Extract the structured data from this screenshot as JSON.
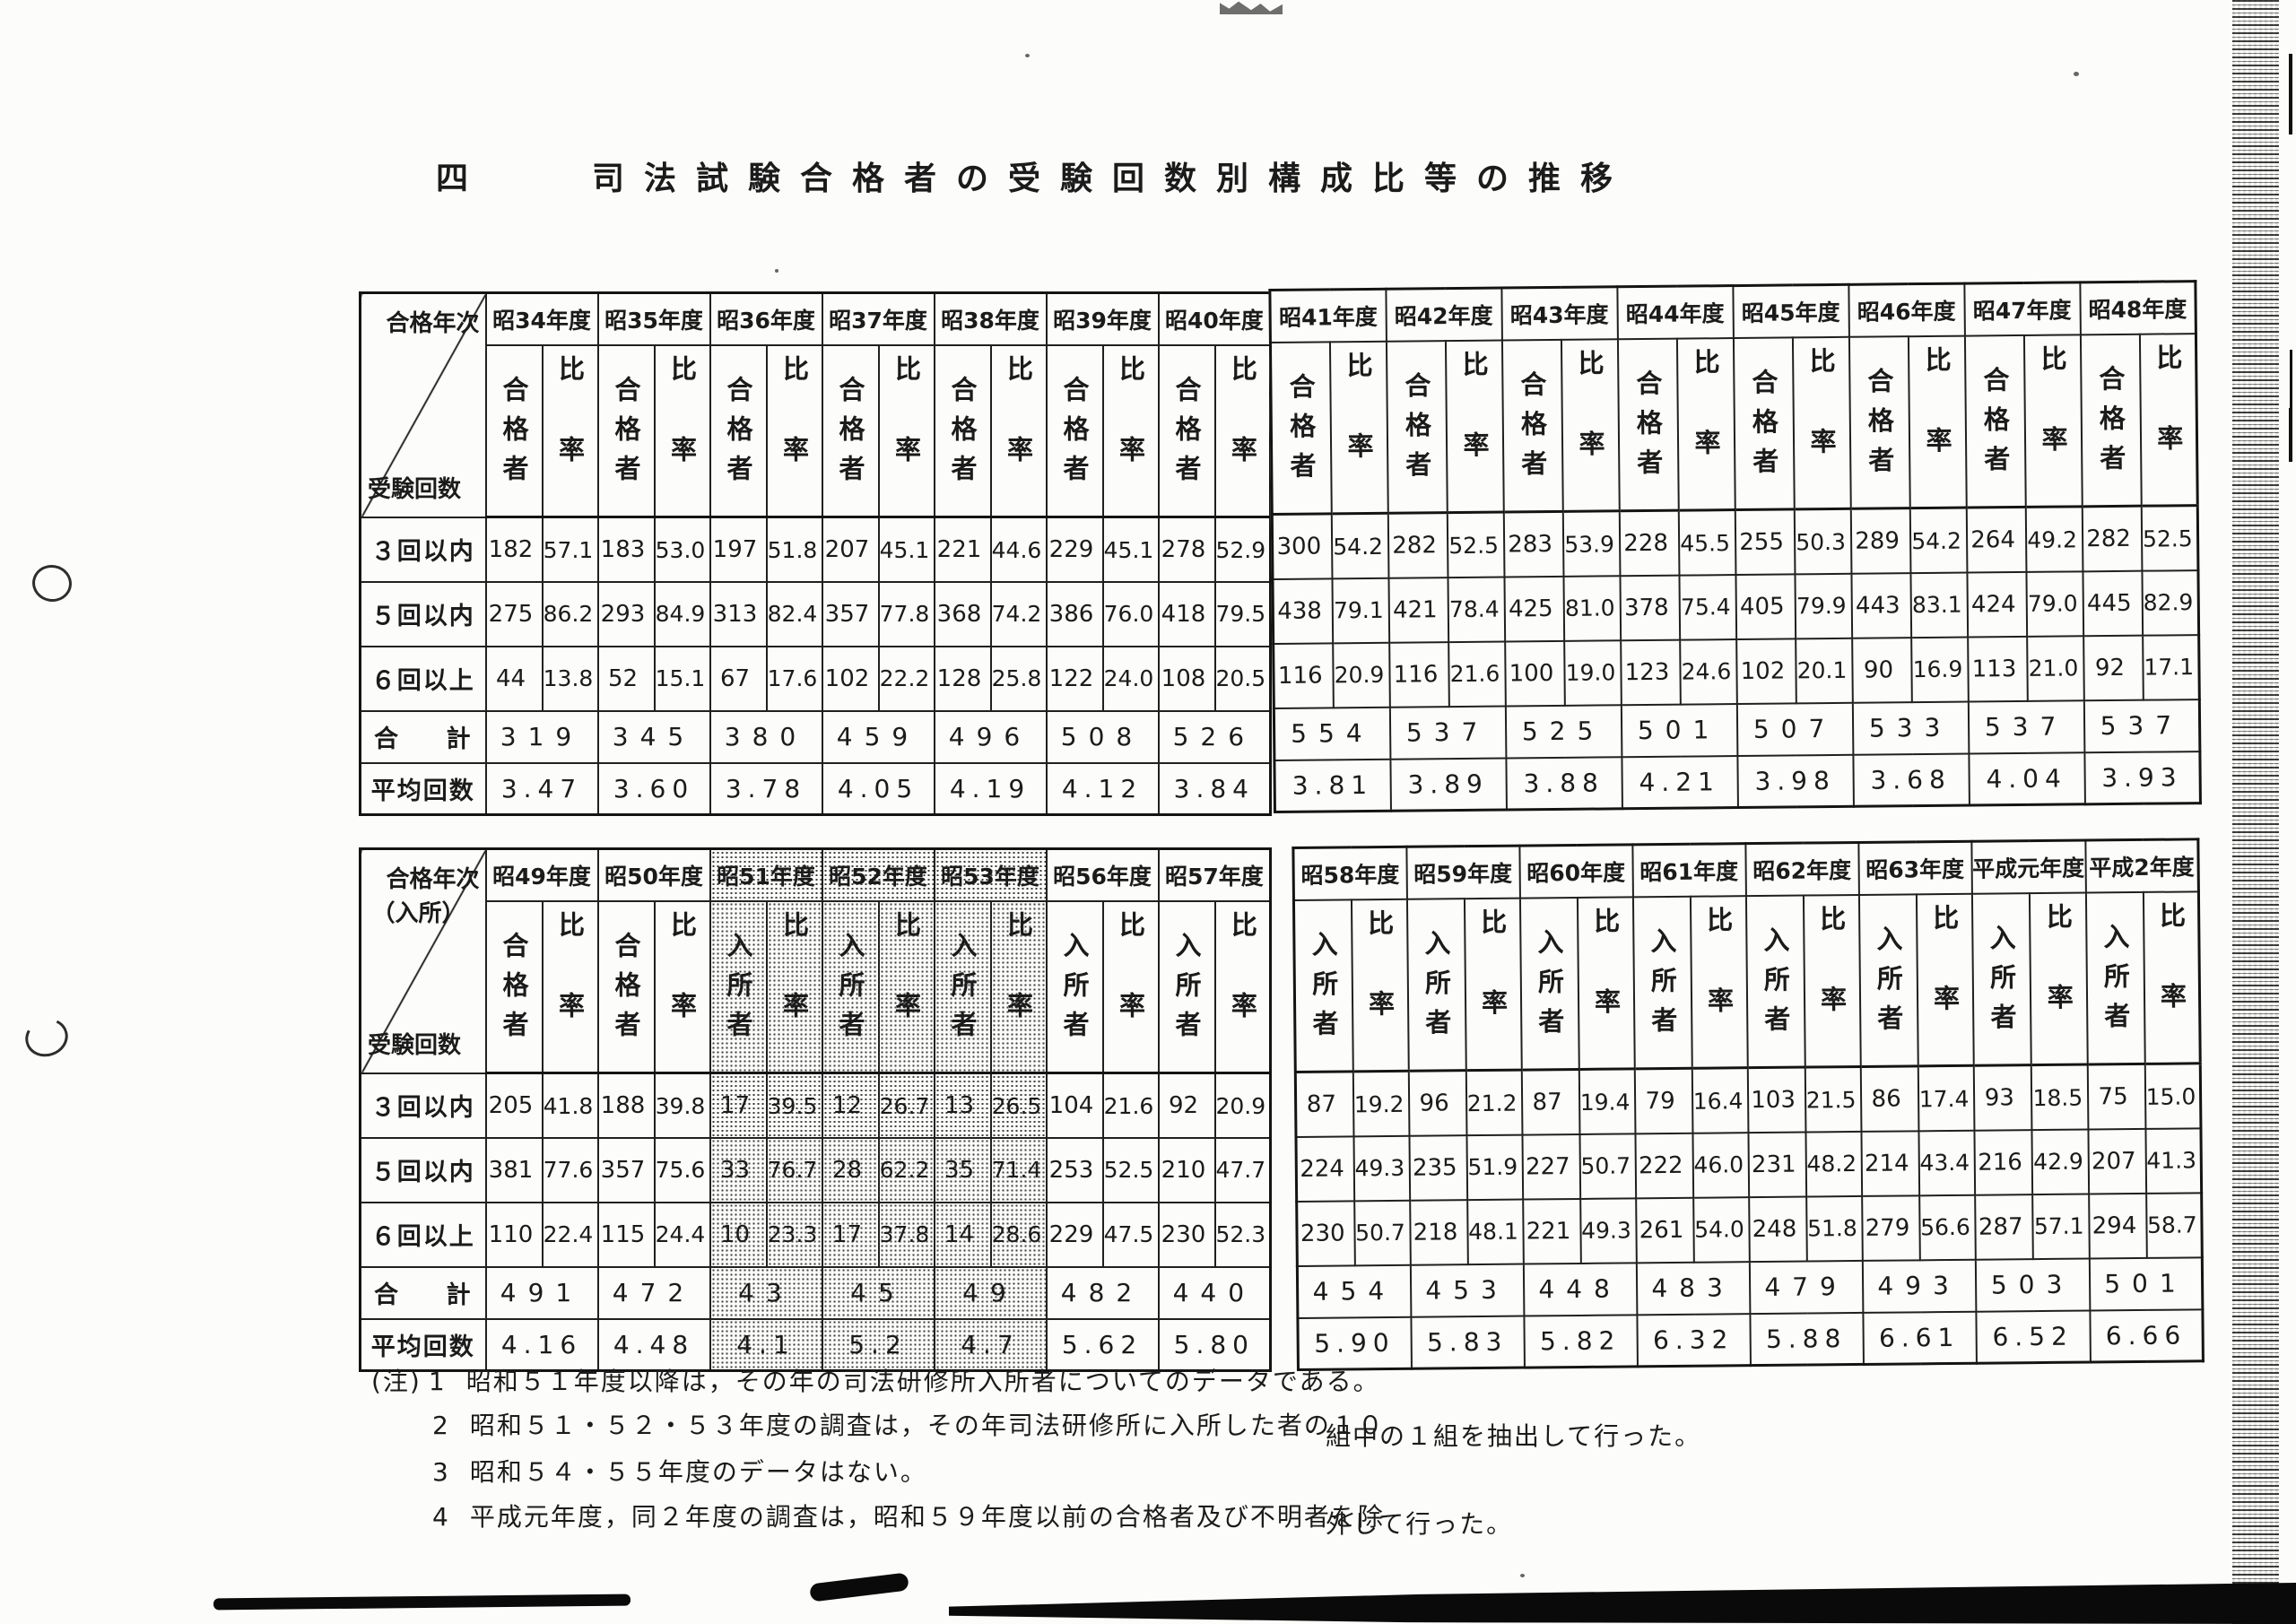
{
  "title": "四　　司法試験合格者の受験回数別構成比等の推移",
  "table1": {
    "corner_top": "合格年次",
    "corner_top2": "",
    "corner_bottom": "受験回数",
    "row_labels": {
      "r3": "３回以内",
      "r5": "５回以内",
      "r6": "６回以上",
      "total": "合　計",
      "avg": "平均回数"
    },
    "left": {
      "years": [
        {
          "year": "昭34年度",
          "head": "合格者",
          "rate_head": "比率",
          "shaded": false,
          "r3": [
            "182",
            "57.1"
          ],
          "r5": [
            "275",
            "86.2"
          ],
          "r6": [
            "44",
            "13.8"
          ],
          "total": "319",
          "avg": "3.47"
        },
        {
          "year": "昭35年度",
          "head": "合格者",
          "rate_head": "比率",
          "shaded": false,
          "r3": [
            "183",
            "53.0"
          ],
          "r5": [
            "293",
            "84.9"
          ],
          "r6": [
            "52",
            "15.1"
          ],
          "total": "345",
          "avg": "3.60"
        },
        {
          "year": "昭36年度",
          "head": "合格者",
          "rate_head": "比率",
          "shaded": false,
          "r3": [
            "197",
            "51.8"
          ],
          "r5": [
            "313",
            "82.4"
          ],
          "r6": [
            "67",
            "17.6"
          ],
          "total": "380",
          "avg": "3.78"
        },
        {
          "year": "昭37年度",
          "head": "合格者",
          "rate_head": "比率",
          "shaded": false,
          "r3": [
            "207",
            "45.1"
          ],
          "r5": [
            "357",
            "77.8"
          ],
          "r6": [
            "102",
            "22.2"
          ],
          "total": "459",
          "avg": "4.05"
        },
        {
          "year": "昭38年度",
          "head": "合格者",
          "rate_head": "比率",
          "shaded": false,
          "r3": [
            "221",
            "44.6"
          ],
          "r5": [
            "368",
            "74.2"
          ],
          "r6": [
            "128",
            "25.8"
          ],
          "total": "496",
          "avg": "4.19"
        },
        {
          "year": "昭39年度",
          "head": "合格者",
          "rate_head": "比率",
          "shaded": false,
          "r3": [
            "229",
            "45.1"
          ],
          "r5": [
            "386",
            "76.0"
          ],
          "r6": [
            "122",
            "24.0"
          ],
          "total": "508",
          "avg": "4.12"
        },
        {
          "year": "昭40年度",
          "head": "合格者",
          "rate_head": "比率",
          "shaded": false,
          "r3": [
            "278",
            "52.9"
          ],
          "r5": [
            "418",
            "79.5"
          ],
          "r6": [
            "108",
            "20.5"
          ],
          "total": "526",
          "avg": "3.84"
        }
      ]
    },
    "right": {
      "years": [
        {
          "year": "昭41年度",
          "head": "合格者",
          "rate_head": "比率",
          "shaded": false,
          "r3": [
            "300",
            "54.2"
          ],
          "r5": [
            "438",
            "79.1"
          ],
          "r6": [
            "116",
            "20.9"
          ],
          "total": "554",
          "avg": "3.81"
        },
        {
          "year": "昭42年度",
          "head": "合格者",
          "rate_head": "比率",
          "shaded": false,
          "r3": [
            "282",
            "52.5"
          ],
          "r5": [
            "421",
            "78.4"
          ],
          "r6": [
            "116",
            "21.6"
          ],
          "total": "537",
          "avg": "3.89"
        },
        {
          "year": "昭43年度",
          "head": "合格者",
          "rate_head": "比率",
          "shaded": false,
          "r3": [
            "283",
            "53.9"
          ],
          "r5": [
            "425",
            "81.0"
          ],
          "r6": [
            "100",
            "19.0"
          ],
          "total": "525",
          "avg": "3.88"
        },
        {
          "year": "昭44年度",
          "head": "合格者",
          "rate_head": "比率",
          "shaded": false,
          "r3": [
            "228",
            "45.5"
          ],
          "r5": [
            "378",
            "75.4"
          ],
          "r6": [
            "123",
            "24.6"
          ],
          "total": "501",
          "avg": "4.21"
        },
        {
          "year": "昭45年度",
          "head": "合格者",
          "rate_head": "比率",
          "shaded": false,
          "r3": [
            "255",
            "50.3"
          ],
          "r5": [
            "405",
            "79.9"
          ],
          "r6": [
            "102",
            "20.1"
          ],
          "total": "507",
          "avg": "3.98"
        },
        {
          "year": "昭46年度",
          "head": "合格者",
          "rate_head": "比率",
          "shaded": false,
          "r3": [
            "289",
            "54.2"
          ],
          "r5": [
            "443",
            "83.1"
          ],
          "r6": [
            "90",
            "16.9"
          ],
          "total": "533",
          "avg": "3.68"
        },
        {
          "year": "昭47年度",
          "head": "合格者",
          "rate_head": "比率",
          "shaded": false,
          "r3": [
            "264",
            "49.2"
          ],
          "r5": [
            "424",
            "79.0"
          ],
          "r6": [
            "113",
            "21.0"
          ],
          "total": "537",
          "avg": "4.04"
        },
        {
          "year": "昭48年度",
          "head": "合格者",
          "rate_head": "比率",
          "shaded": false,
          "r3": [
            "282",
            "52.5"
          ],
          "r5": [
            "445",
            "82.9"
          ],
          "r6": [
            "92",
            "17.1"
          ],
          "total": "537",
          "avg": "3.93"
        }
      ]
    }
  },
  "table2": {
    "corner_top": "合格年次",
    "corner_top2": "（入所）",
    "corner_bottom": "受験回数",
    "row_labels": {
      "r3": "３回以内",
      "r5": "５回以内",
      "r6": "６回以上",
      "total": "合　計",
      "avg": "平均回数"
    },
    "left": {
      "years": [
        {
          "year": "昭49年度",
          "head": "合格者",
          "rate_head": "比率",
          "shaded": false,
          "r3": [
            "205",
            "41.8"
          ],
          "r5": [
            "381",
            "77.6"
          ],
          "r6": [
            "110",
            "22.4"
          ],
          "total": "491",
          "avg": "4.16"
        },
        {
          "year": "昭50年度",
          "head": "合格者",
          "rate_head": "比率",
          "shaded": false,
          "r3": [
            "188",
            "39.8"
          ],
          "r5": [
            "357",
            "75.6"
          ],
          "r6": [
            "115",
            "24.4"
          ],
          "total": "472",
          "avg": "4.48"
        },
        {
          "year": "昭51年度",
          "head": "入所者",
          "rate_head": "比率",
          "shaded": true,
          "r3": [
            "17",
            "39.5"
          ],
          "r5": [
            "33",
            "76.7"
          ],
          "r6": [
            "10",
            "23.3"
          ],
          "total": "43",
          "avg": "4.1"
        },
        {
          "year": "昭52年度",
          "head": "入所者",
          "rate_head": "比率",
          "shaded": true,
          "r3": [
            "12",
            "26.7"
          ],
          "r5": [
            "28",
            "62.2"
          ],
          "r6": [
            "17",
            "37.8"
          ],
          "total": "45",
          "avg": "5.2"
        },
        {
          "year": "昭53年度",
          "head": "入所者",
          "rate_head": "比率",
          "shaded": true,
          "r3": [
            "13",
            "26.5"
          ],
          "r5": [
            "35",
            "71.4"
          ],
          "r6": [
            "14",
            "28.6"
          ],
          "total": "49",
          "avg": "4.7"
        },
        {
          "year": "昭56年度",
          "head": "入所者",
          "rate_head": "比率",
          "shaded": false,
          "r3": [
            "104",
            "21.6"
          ],
          "r5": [
            "253",
            "52.5"
          ],
          "r6": [
            "229",
            "47.5"
          ],
          "total": "482",
          "avg": "5.62"
        },
        {
          "year": "昭57年度",
          "head": "入所者",
          "rate_head": "比率",
          "shaded": false,
          "r3": [
            "92",
            "20.9"
          ],
          "r5": [
            "210",
            "47.7"
          ],
          "r6": [
            "230",
            "52.3"
          ],
          "total": "440",
          "avg": "5.80"
        }
      ]
    },
    "right": {
      "years": [
        {
          "year": "昭58年度",
          "head": "入所者",
          "rate_head": "比率",
          "shaded": false,
          "r3": [
            "87",
            "19.2"
          ],
          "r5": [
            "224",
            "49.3"
          ],
          "r6": [
            "230",
            "50.7"
          ],
          "total": "454",
          "avg": "5.90"
        },
        {
          "year": "昭59年度",
          "head": "入所者",
          "rate_head": "比率",
          "shaded": false,
          "r3": [
            "96",
            "21.2"
          ],
          "r5": [
            "235",
            "51.9"
          ],
          "r6": [
            "218",
            "48.1"
          ],
          "total": "453",
          "avg": "5.83"
        },
        {
          "year": "昭60年度",
          "head": "入所者",
          "rate_head": "比率",
          "shaded": false,
          "r3": [
            "87",
            "19.4"
          ],
          "r5": [
            "227",
            "50.7"
          ],
          "r6": [
            "221",
            "49.3"
          ],
          "total": "448",
          "avg": "5.82"
        },
        {
          "year": "昭61年度",
          "head": "入所者",
          "rate_head": "比率",
          "shaded": false,
          "r3": [
            "79",
            "16.4"
          ],
          "r5": [
            "222",
            "46.0"
          ],
          "r6": [
            "261",
            "54.0"
          ],
          "total": "483",
          "avg": "6.32"
        },
        {
          "year": "昭62年度",
          "head": "入所者",
          "rate_head": "比率",
          "shaded": false,
          "r3": [
            "103",
            "21.5"
          ],
          "r5": [
            "231",
            "48.2"
          ],
          "r6": [
            "248",
            "51.8"
          ],
          "total": "479",
          "avg": "5.88"
        },
        {
          "year": "昭63年度",
          "head": "入所者",
          "rate_head": "比率",
          "shaded": false,
          "r3": [
            "86",
            "17.4"
          ],
          "r5": [
            "214",
            "43.4"
          ],
          "r6": [
            "279",
            "56.6"
          ],
          "total": "493",
          "avg": "6.61"
        },
        {
          "year": "平成元年度",
          "head": "入所者",
          "rate_head": "比率",
          "shaded": false,
          "r3": [
            "93",
            "18.5"
          ],
          "r5": [
            "216",
            "42.9"
          ],
          "r6": [
            "287",
            "57.1"
          ],
          "total": "503",
          "avg": "6.52"
        },
        {
          "year": "平成2年度",
          "head": "入所者",
          "rate_head": "比率",
          "shaded": false,
          "r3": [
            "75",
            "15.0"
          ],
          "r5": [
            "207",
            "41.3"
          ],
          "r6": [
            "294",
            "58.7"
          ],
          "total": "501",
          "avg": "6.66"
        }
      ]
    }
  },
  "notes": {
    "mark": "(注)",
    "items": [
      {
        "num": "1",
        "text": "昭和５１年度以降は，その年の司法研修所入所者についてのデータである。"
      },
      {
        "num": "2",
        "text": "昭和５１・５２・５３年度の調査は，その年司法研修所に入所した者の１０"
      },
      {
        "num": "3",
        "text": "昭和５４・５５年度のデータはない。"
      },
      {
        "num": "4",
        "text": "平成元年度，同２年度の調査は，昭和５９年度以前の合格者及び不明者を除"
      }
    ],
    "continuations": [
      "組中の１組を抽出して行った。",
      "外して行った。"
    ]
  }
}
